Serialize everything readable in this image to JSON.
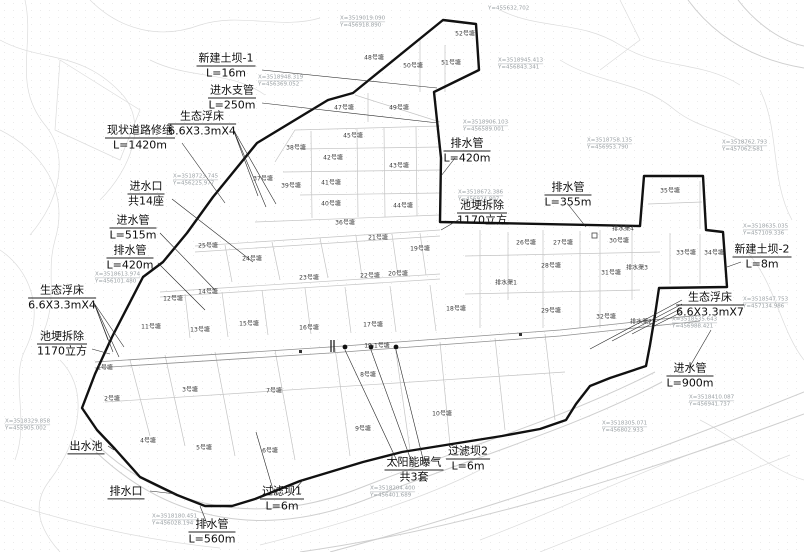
{
  "colors": {
    "boundary_line": "#111111",
    "parcel_line": "#c4c4c4",
    "road_line": "#8f8f8f",
    "annotation_text": "#0e0e0e",
    "coordinate_text": "#9aa0a4",
    "background": "#ffffff"
  },
  "annotations": [
    {
      "name": "new-earth-dam-1",
      "lines": [
        "新建土坝-1",
        "L=16m"
      ],
      "x": 226,
      "y": 66
    },
    {
      "name": "inlet-branch-pipe",
      "lines": [
        "进水支管",
        "L=250m"
      ],
      "x": 232,
      "y": 98
    },
    {
      "name": "eco-floating-bed-top",
      "lines": [
        "生态浮床",
        "6.6X3.3mX4"
      ],
      "x": 202,
      "y": 124
    },
    {
      "name": "existing-road-repair",
      "lines": [
        "现状道路修缮",
        "L=1420m"
      ],
      "x": 140,
      "y": 138
    },
    {
      "name": "inlet-openings",
      "lines": [
        "进水口",
        "共14座"
      ],
      "x": 146,
      "y": 194
    },
    {
      "name": "inlet-pipe-515",
      "lines": [
        "进水管",
        "L=515m"
      ],
      "x": 133,
      "y": 228
    },
    {
      "name": "drain-pipe-420-left",
      "lines": [
        "排水管",
        "L=420m"
      ],
      "x": 130,
      "y": 258
    },
    {
      "name": "eco-floating-bed-left",
      "lines": [
        "生态浮床",
        "6.6X3.3mX4"
      ],
      "x": 62,
      "y": 298
    },
    {
      "name": "pond-bank-demolition-left",
      "lines": [
        "池埂拆除",
        "1170立方"
      ],
      "x": 62,
      "y": 344
    },
    {
      "name": "outlet-pool",
      "lines": [
        "出水池"
      ],
      "x": 86,
      "y": 447
    },
    {
      "name": "drain-outlet",
      "lines": [
        "排水口"
      ],
      "x": 126,
      "y": 492
    },
    {
      "name": "drain-pipe-560",
      "lines": [
        "排水管",
        "L=560m"
      ],
      "x": 212,
      "y": 532
    },
    {
      "name": "filter-dam-1",
      "lines": [
        "过滤坝1",
        "L=6m"
      ],
      "x": 282,
      "y": 499
    },
    {
      "name": "solar-aeration",
      "lines": [
        "太阳能曝气",
        "共3套"
      ],
      "x": 414,
      "y": 470
    },
    {
      "name": "filter-dam-2",
      "lines": [
        "过滤坝2",
        "L=6m"
      ],
      "x": 468,
      "y": 459
    },
    {
      "name": "drain-pipe-420-right",
      "lines": [
        "排水管",
        "L=420m"
      ],
      "x": 467,
      "y": 151
    },
    {
      "name": "drain-pipe-355",
      "lines": [
        "排水管",
        "L=355m"
      ],
      "x": 568,
      "y": 195
    },
    {
      "name": "pond-bank-demolition-right",
      "lines": [
        "池埂拆除",
        "1170立方"
      ],
      "x": 482,
      "y": 213
    },
    {
      "name": "new-earth-dam-2",
      "lines": [
        "新建土坝-2",
        "L=8m"
      ],
      "x": 762,
      "y": 257
    },
    {
      "name": "eco-floating-bed-right",
      "lines": [
        "生态浮床",
        "6.6X3.3mX7"
      ],
      "x": 710,
      "y": 305
    },
    {
      "name": "inlet-pipe-900",
      "lines": [
        "进水管",
        "L=900m"
      ],
      "x": 690,
      "y": 376
    }
  ],
  "pond_labels": [
    {
      "label": "1号塘",
      "x": 105,
      "y": 367
    },
    {
      "label": "2号塘",
      "x": 112,
      "y": 398
    },
    {
      "label": "3号塘",
      "x": 190,
      "y": 389
    },
    {
      "label": "4号塘",
      "x": 148,
      "y": 440
    },
    {
      "label": "5号塘",
      "x": 204,
      "y": 447
    },
    {
      "label": "6号塘",
      "x": 270,
      "y": 450
    },
    {
      "label": "7号塘",
      "x": 274,
      "y": 390
    },
    {
      "label": "8号塘",
      "x": 368,
      "y": 374
    },
    {
      "label": "9号塘",
      "x": 363,
      "y": 428
    },
    {
      "label": "10号塘",
      "x": 442,
      "y": 413
    },
    {
      "label": "11号塘",
      "x": 151,
      "y": 326
    },
    {
      "label": "12号塘",
      "x": 173,
      "y": 298
    },
    {
      "label": "13号塘",
      "x": 200,
      "y": 329
    },
    {
      "label": "14号塘",
      "x": 208,
      "y": 291
    },
    {
      "label": "15号塘",
      "x": 249,
      "y": 323
    },
    {
      "label": "16号塘",
      "x": 309,
      "y": 327
    },
    {
      "label": "17号塘",
      "x": 373,
      "y": 324
    },
    {
      "label": "18号塘",
      "x": 456,
      "y": 308
    },
    {
      "label": "19号塘",
      "x": 420,
      "y": 248
    },
    {
      "label": "20号塘",
      "x": 398,
      "y": 273
    },
    {
      "label": "21号塘",
      "x": 378,
      "y": 237
    },
    {
      "label": "22号塘",
      "x": 370,
      "y": 275
    },
    {
      "label": "23号塘",
      "x": 309,
      "y": 277
    },
    {
      "label": "24号塘",
      "x": 252,
      "y": 258
    },
    {
      "label": "25号塘",
      "x": 208,
      "y": 245
    },
    {
      "label": "26号塘",
      "x": 526,
      "y": 242
    },
    {
      "label": "27号塘",
      "x": 563,
      "y": 242
    },
    {
      "label": "28号塘",
      "x": 551,
      "y": 265
    },
    {
      "label": "29号塘",
      "x": 551,
      "y": 310
    },
    {
      "label": "30号塘",
      "x": 619,
      "y": 240
    },
    {
      "label": "31号塘",
      "x": 611,
      "y": 272
    },
    {
      "label": "32号塘",
      "x": 606,
      "y": 316
    },
    {
      "label": "33号塘",
      "x": 686,
      "y": 252
    },
    {
      "label": "34号塘",
      "x": 714,
      "y": 252
    },
    {
      "label": "35号塘",
      "x": 670,
      "y": 190
    },
    {
      "label": "36号塘",
      "x": 345,
      "y": 222
    },
    {
      "label": "37号塘",
      "x": 263,
      "y": 178
    },
    {
      "label": "38号塘",
      "x": 296,
      "y": 147
    },
    {
      "label": "39号塘",
      "x": 291,
      "y": 185
    },
    {
      "label": "40号塘",
      "x": 331,
      "y": 203
    },
    {
      "label": "41号塘",
      "x": 331,
      "y": 182
    },
    {
      "label": "42号塘",
      "x": 333,
      "y": 157
    },
    {
      "label": "43号塘",
      "x": 399,
      "y": 165
    },
    {
      "label": "44号塘",
      "x": 403,
      "y": 205
    },
    {
      "label": "45号塘",
      "x": 353,
      "y": 135
    },
    {
      "label": "47号塘",
      "x": 344,
      "y": 107
    },
    {
      "label": "48号塘",
      "x": 374,
      "y": 57
    },
    {
      "label": "49号塘",
      "x": 399,
      "y": 107
    },
    {
      "label": "50号塘",
      "x": 413,
      "y": 65
    },
    {
      "label": "51号塘",
      "x": 451,
      "y": 62
    },
    {
      "label": "52号塘",
      "x": 465,
      "y": 33
    },
    {
      "label": "19-1号塘",
      "x": 377,
      "y": 345
    }
  ],
  "channel_labels": [
    {
      "label": "排水渠1",
      "x": 506,
      "y": 282
    },
    {
      "label": "排水渠2",
      "x": 641,
      "y": 321
    },
    {
      "label": "排水渠3",
      "x": 637,
      "y": 267
    },
    {
      "label": "排水渠4",
      "x": 623,
      "y": 228
    }
  ],
  "coordinate_labels": [
    {
      "x_text": "X=3519019.090",
      "y_text": "Y=456918.890",
      "x": 340,
      "y": 15
    },
    {
      "x_text": "",
      "y_text": "Y=455632.702",
      "x": 488,
      "y": 5
    },
    {
      "x_text": "X=3518945.413",
      "y_text": "Y=456843.341",
      "x": 498,
      "y": 57
    },
    {
      "x_text": "X=3518948.319",
      "y_text": "Y=456369.052",
      "x": 258,
      "y": 74
    },
    {
      "x_text": "X=3518906.103",
      "y_text": "Y=456589.001",
      "x": 463,
      "y": 119
    },
    {
      "x_text": "X=3518723.745",
      "y_text": "Y=456225.977",
      "x": 173,
      "y": 173
    },
    {
      "x_text": "X=3518758.135",
      "y_text": "Y=456953.790",
      "x": 587,
      "y": 137
    },
    {
      "x_text": "X=3518762.793",
      "y_text": "Y=457062.581",
      "x": 722,
      "y": 139
    },
    {
      "x_text": "X=3518672.386",
      "y_text": "Y=456924.807",
      "x": 458,
      "y": 189
    },
    {
      "x_text": "X=3518635.035",
      "y_text": "Y=457109.336",
      "x": 743,
      "y": 223
    },
    {
      "x_text": "X=3518613.974",
      "y_text": "Y=456101.480",
      "x": 95,
      "y": 271
    },
    {
      "x_text": "X=3518329.858",
      "y_text": "Y=455905.002",
      "x": 5,
      "y": 418
    },
    {
      "x_text": "X=3518180.451",
      "y_text": "Y=456028.194",
      "x": 152,
      "y": 513
    },
    {
      "x_text": "X=3518204.400",
      "y_text": "Y=456401.689",
      "x": 370,
      "y": 485
    },
    {
      "x_text": "X=3518547.753",
      "y_text": "Y=457134.986",
      "x": 743,
      "y": 296
    },
    {
      "x_text": "X=3518535.643",
      "y_text": "Y=456988.421",
      "x": 672,
      "y": 316
    },
    {
      "x_text": "X=3518410.087",
      "y_text": "Y=456941.737",
      "x": 689,
      "y": 394
    },
    {
      "x_text": "X=3518305.071",
      "y_text": "Y=456802.933",
      "x": 602,
      "y": 420
    }
  ],
  "features": {
    "aeration_dot_count": 3
  }
}
